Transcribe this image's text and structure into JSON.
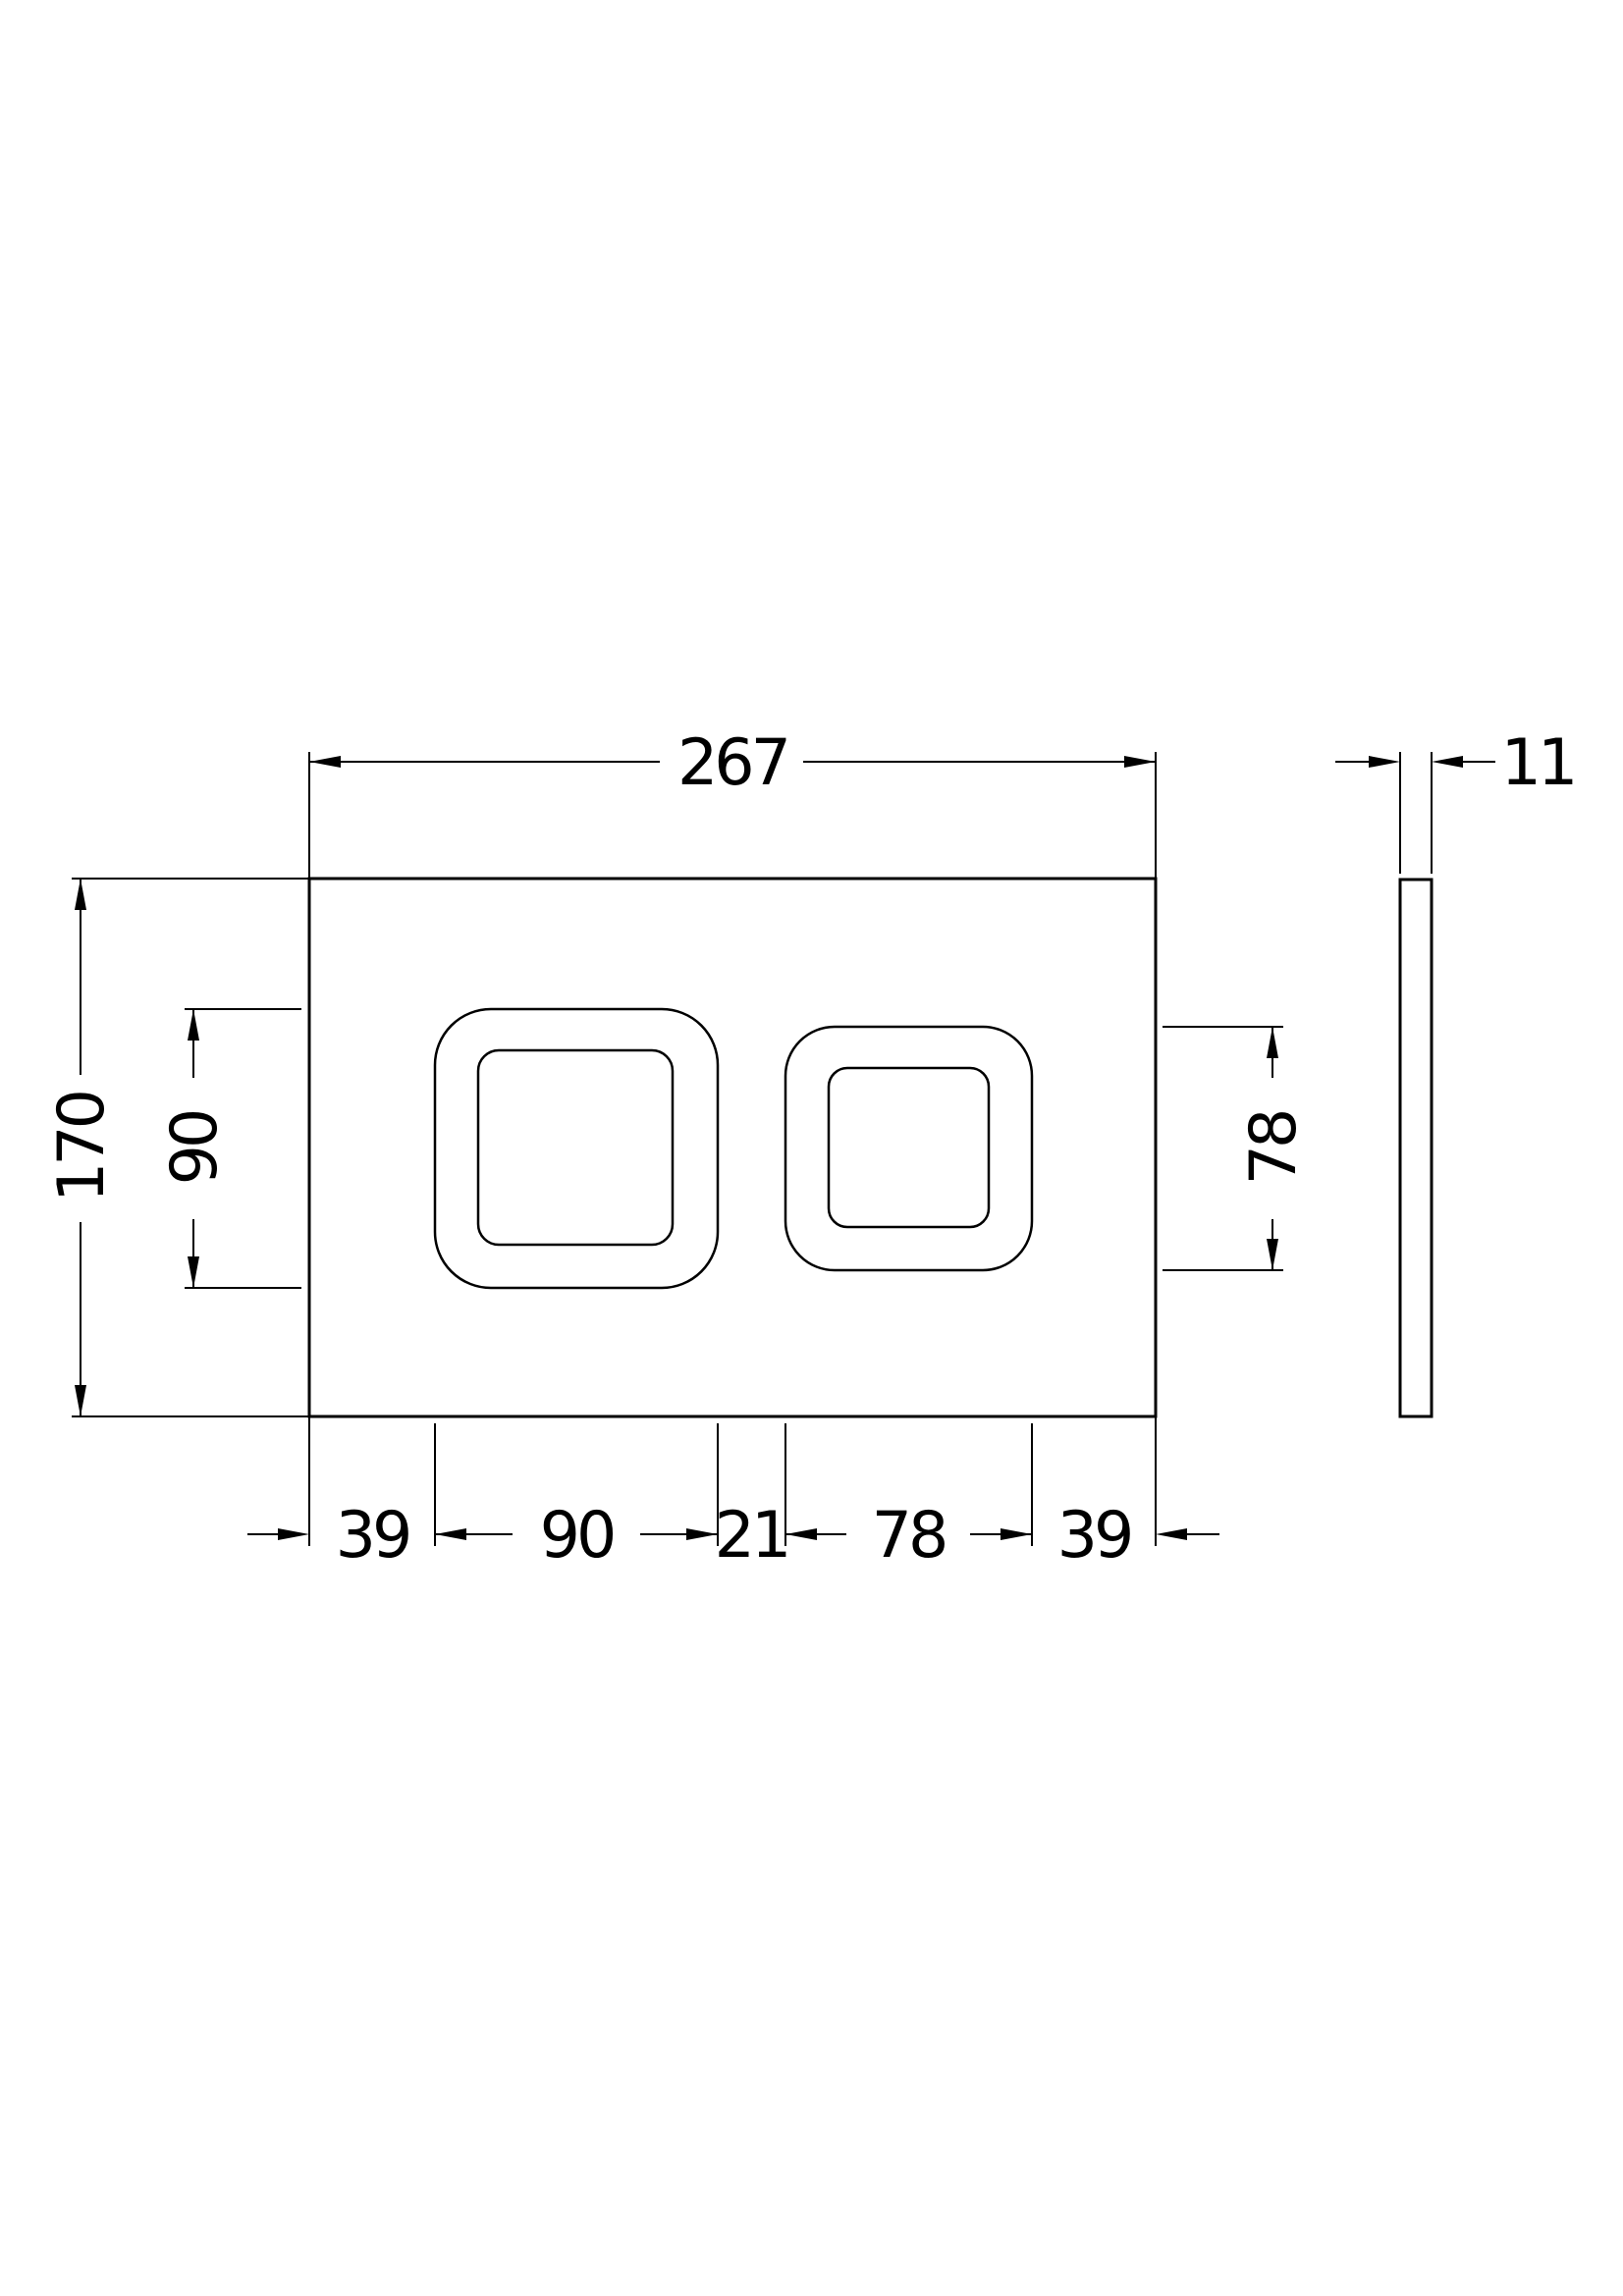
{
  "drawing": {
    "colors": {
      "line": "#000000",
      "background": "#ffffff"
    },
    "dimensions": {
      "overall_width": "267",
      "thickness": "11",
      "overall_height": "170",
      "left_button_height": "90",
      "right_button_height": "78",
      "bottom_row": [
        "39",
        "90",
        "21",
        "78",
        "39"
      ]
    }
  }
}
